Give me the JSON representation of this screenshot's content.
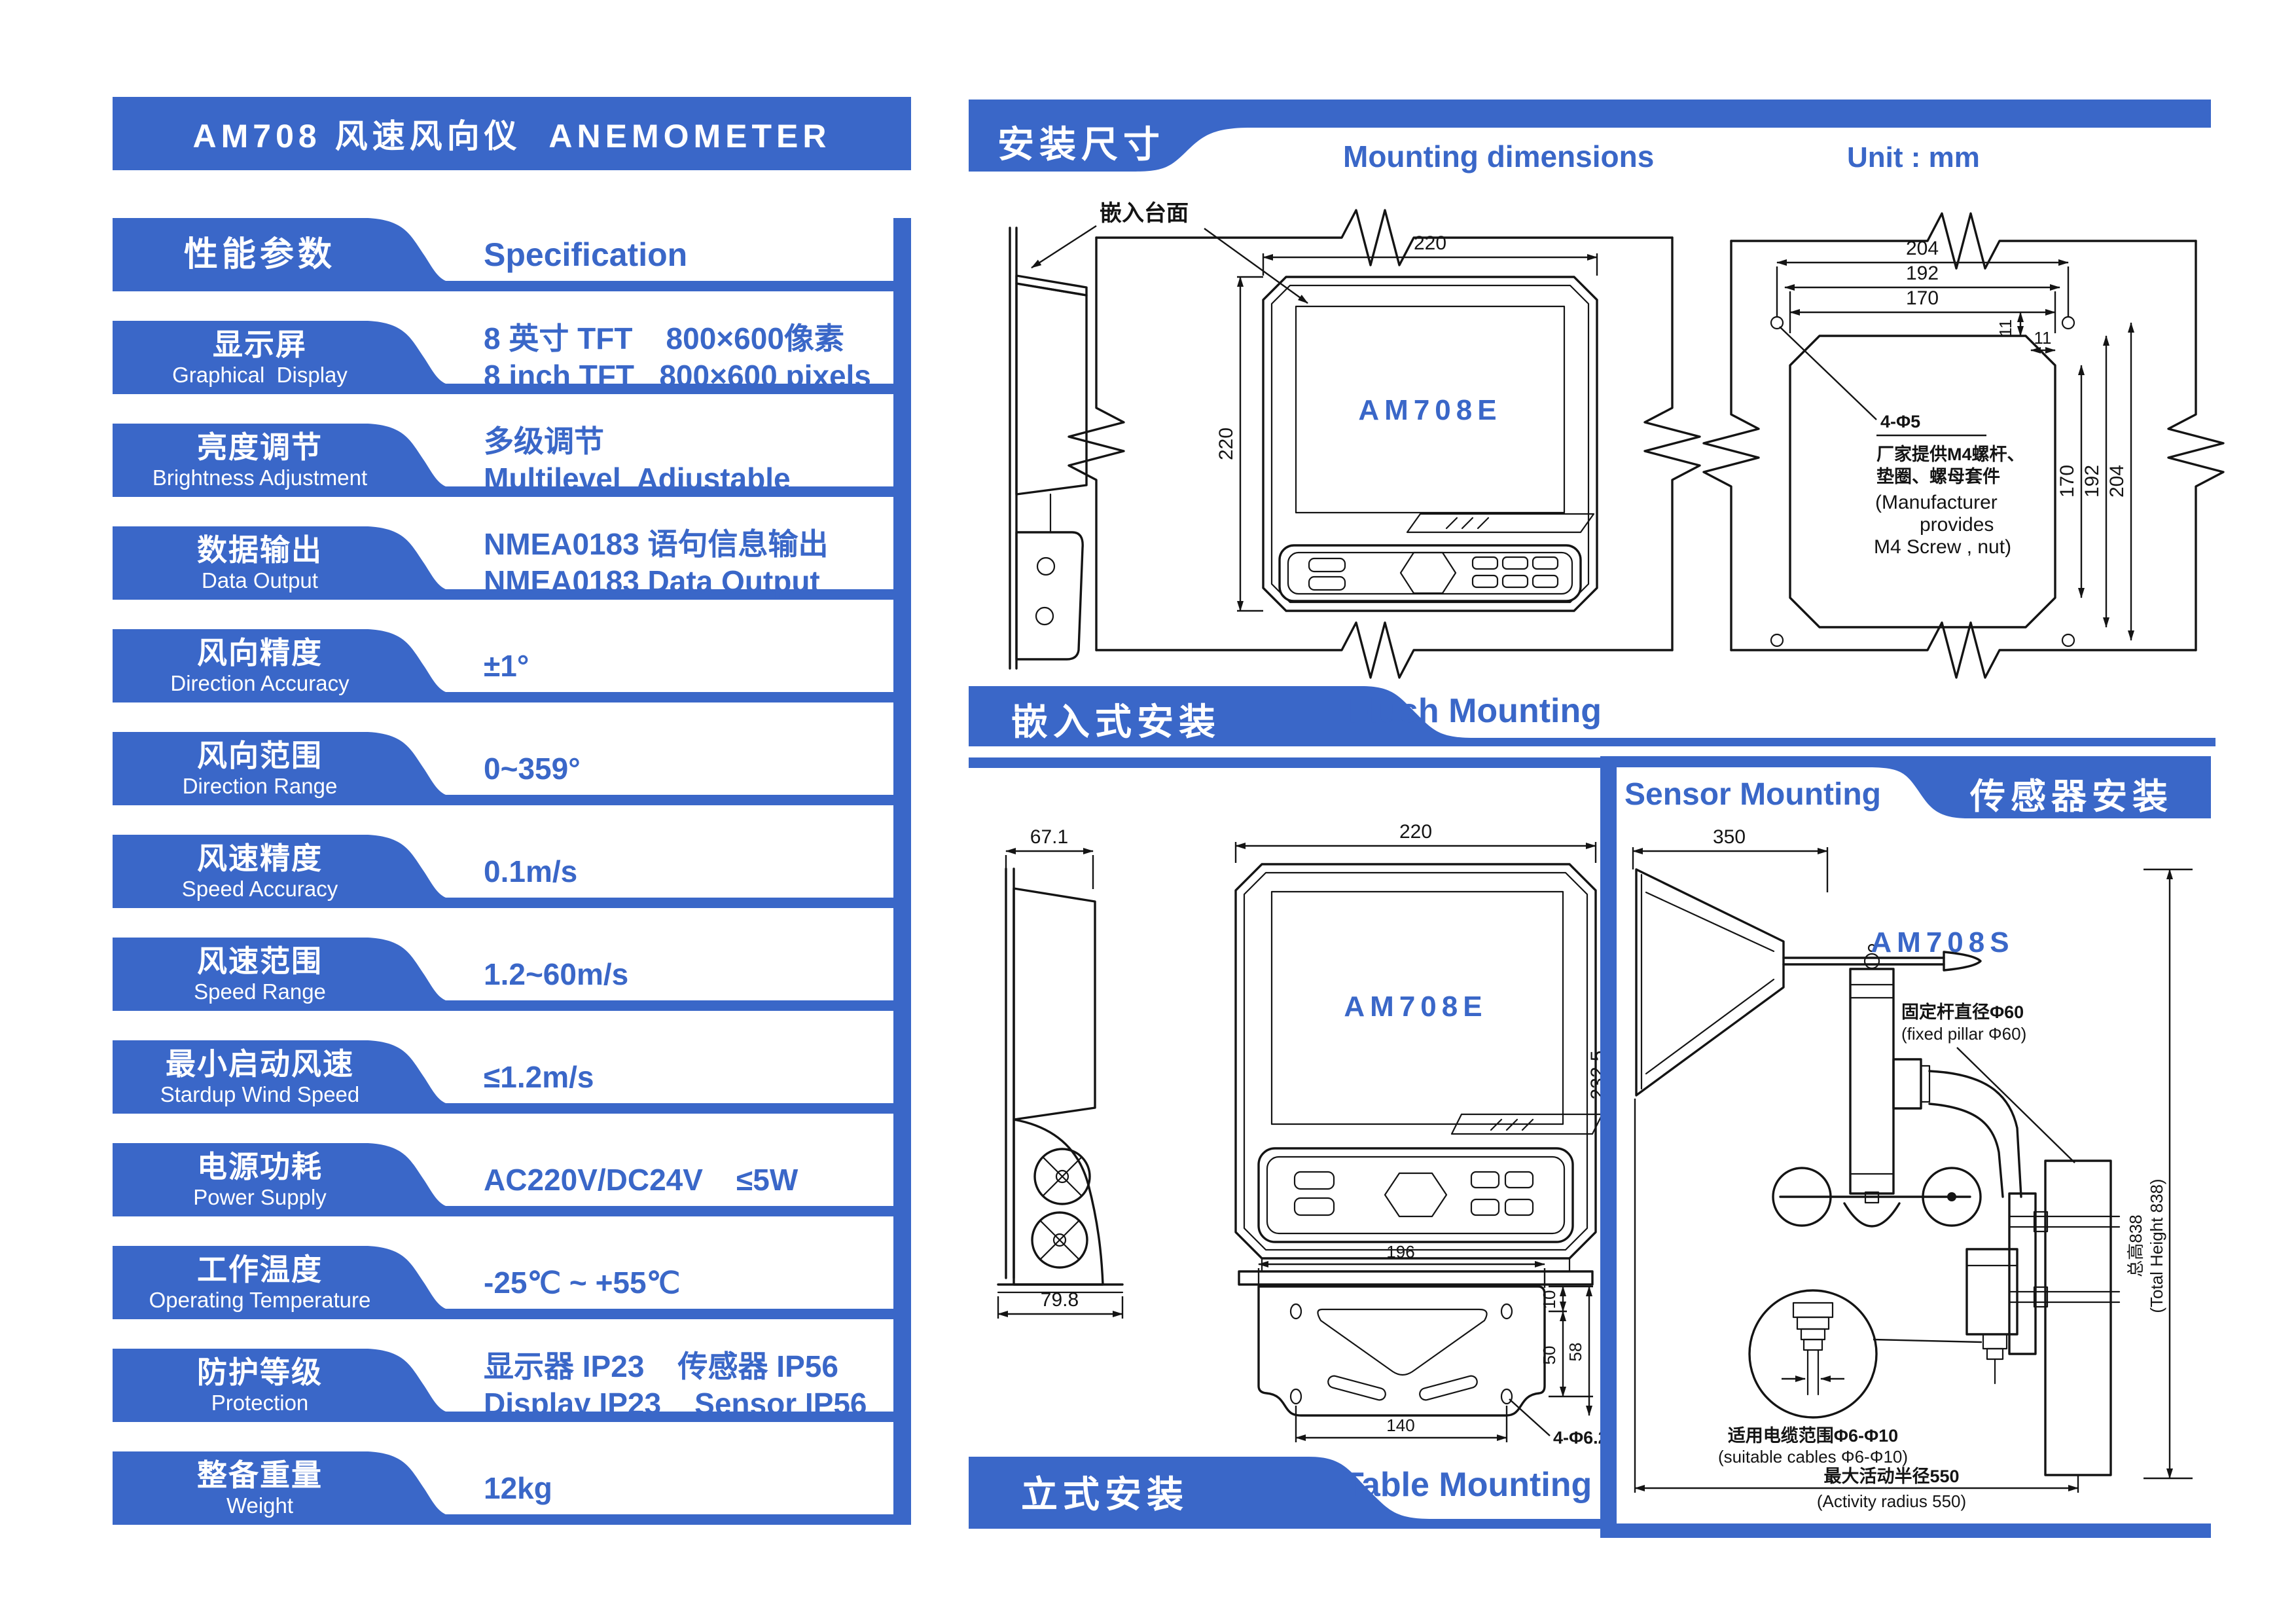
{
  "colors": {
    "accent": "#3A67C8",
    "line": "#141414",
    "background": "#FFFFFF"
  },
  "title": "AM708 风速风向仪  ANEMOMETER",
  "spec_table": {
    "header": {
      "zh": "性能参数",
      "value": "Specification"
    },
    "rows": [
      {
        "zh": "显示屏",
        "en": "Graphical  Display",
        "value_line1": "8 英寸 TFT    800×600像素",
        "value_line2": "8 inch TFT   800×600 pixels"
      },
      {
        "zh": "亮度调节",
        "en": "Brightness Adjustment",
        "value_line1": "多级调节",
        "value_line2": "Multilevel  Adjustable"
      },
      {
        "zh": "数据输出",
        "en": "Data Output",
        "value_line1": "NMEA0183 语句信息输出",
        "value_line2": "NMEA0183 Data Output"
      },
      {
        "zh": "风向精度",
        "en": "Direction Accuracy",
        "value_line1": "±1°",
        "value_line2": ""
      },
      {
        "zh": "风向范围",
        "en": "Direction Range",
        "value_line1": "0~359°",
        "value_line2": ""
      },
      {
        "zh": "风速精度",
        "en": "Speed Accuracy",
        "value_line1": "0.1m/s",
        "value_line2": ""
      },
      {
        "zh": "风速范围",
        "en": "Speed Range",
        "value_line1": "1.2~60m/s",
        "value_line2": ""
      },
      {
        "zh": "最小启动风速",
        "en": "Stardup Wind Speed",
        "value_line1": "≤1.2m/s",
        "value_line2": ""
      },
      {
        "zh": "电源功耗",
        "en": "Power Supply",
        "value_line1": "AC220V/DC24V    ≤5W",
        "value_line2": ""
      },
      {
        "zh": "工作温度",
        "en": "Operating Temperature",
        "value_line1": "-25℃ ~ +55℃",
        "value_line2": ""
      },
      {
        "zh": "防护等级",
        "en": "Protection",
        "value_line1": "显示器 IP23    传感器 IP56",
        "value_line2": "Display IP23    Sensor IP56"
      },
      {
        "zh": "整备重量",
        "en": "Weight",
        "value_line1": "12kg",
        "value_line2": ""
      }
    ]
  },
  "sections": {
    "mounting": {
      "zh": "安装尺寸",
      "en": "Mounting dimensions",
      "unit": "Unit : mm"
    },
    "flush": {
      "zh": "嵌入式安装",
      "en": "Flush Mounting"
    },
    "table": {
      "zh": "立式安装",
      "en": "Table Mounting"
    },
    "sensor": {
      "zh": "传感器安装",
      "en": "Sensor Mounting"
    }
  },
  "drawings": {
    "flush_view": {
      "panel_note": "嵌入台面",
      "model": "AM708E",
      "dim_width": "220",
      "dim_height": "220"
    },
    "cutout": {
      "dim_top_outer": "204",
      "dim_top_mid": "192",
      "dim_top_inner": "170",
      "dim_right_inner": "170",
      "dim_right_mid": "192",
      "dim_right_outer": "204",
      "dim_offset_v": "11",
      "dim_offset_h": "11",
      "hole_label": "4-Φ5",
      "note_zh1": "厂家提供M4螺杆、",
      "note_zh2": "垫圈、螺母套件",
      "note_en1": "(Manufacturer",
      "note_en2": "provides",
      "note_en3": "M4 Screw , nut)"
    },
    "table_view": {
      "model": "AM708E",
      "dim_width": "220",
      "dim_height": "232.5",
      "dim_side_top": "67.1",
      "dim_side_bottom": "79.8"
    },
    "bracket": {
      "dim_width": "196",
      "dim_hole_span": "140",
      "dim_a": "50",
      "dim_b": "10",
      "dim_c": "58",
      "hole_label": "4-Φ6.2"
    },
    "sensor": {
      "model": "AM708S",
      "dim_span": "350",
      "pillar_zh": "固定杆直径Φ60",
      "pillar_en": "(fixed pillar Φ60)",
      "height_zh": "总高838",
      "height_en": "(Total Height 838)",
      "cable_zh": "适用电缆范围Φ6-Φ10",
      "cable_en": "(suitable cables Φ6-Φ10)",
      "radius_zh": "最大活动半径550",
      "radius_en": "(Activity radius 550)"
    }
  }
}
